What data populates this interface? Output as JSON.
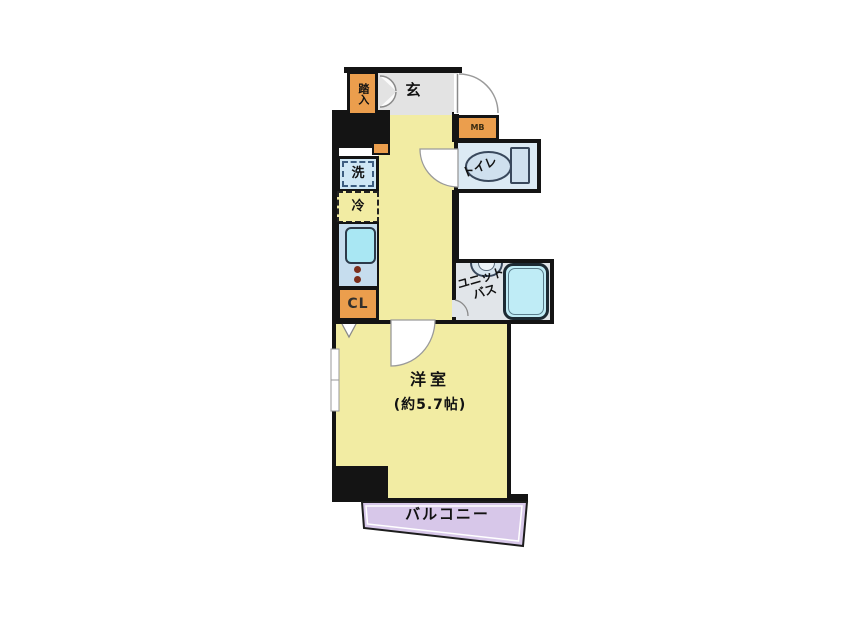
{
  "title": "apartment-floor-plan",
  "colors": {
    "wall": "#141414",
    "floor": "#f2eca3",
    "tile": "#e3e3e3",
    "orange": "#eb9e4d",
    "kitchen": "#c6ddee",
    "sink": "#a9e7f3",
    "washer": "#cfe7f5",
    "toilet": "#dceaf4",
    "porcelain": "#cfe0ee",
    "bath": "#e1e5e9",
    "tub": "#bfecf6",
    "balcony": "#d7c7e9",
    "burner": "#7c2f1d"
  },
  "labels": {
    "fumikomi": "踏入",
    "genkan": "玄",
    "meter_box": "MB",
    "toilet": "トイレ",
    "washer": "洗",
    "fridge": "冷",
    "closet": "CL",
    "unit_bath_line1": "ユニット",
    "unit_bath_line2": "バス",
    "room": "洋室",
    "room_size": "(約5.7帖)",
    "balcony": "バルコニー"
  }
}
